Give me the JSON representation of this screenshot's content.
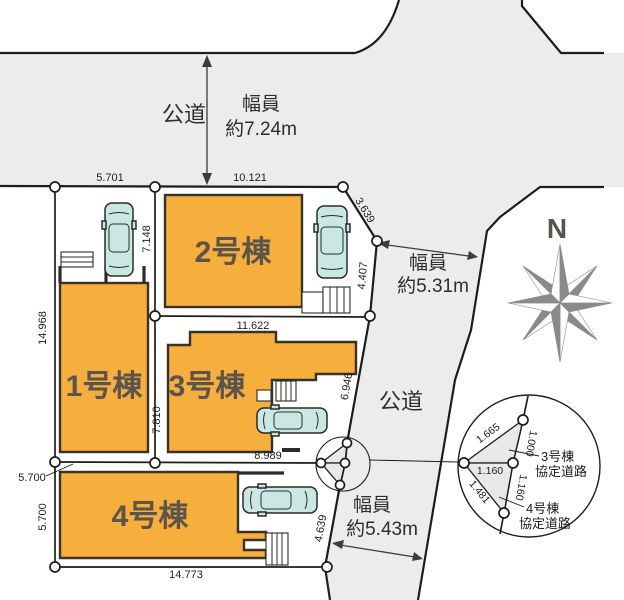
{
  "plan": {
    "buildings": [
      {
        "label": "1号棟"
      },
      {
        "label": "2号棟"
      },
      {
        "label": "3号棟"
      },
      {
        "label": "4号棟"
      }
    ],
    "roads": {
      "top": {
        "name": "公道",
        "width_line1": "幅員",
        "width_line2": "約7.24m"
      },
      "east": {
        "name": "公道",
        "upper_width_line1": "幅員",
        "upper_width_line2": "約5.31m",
        "lower_width_line1": "幅員",
        "lower_width_line2": "約5.43m"
      }
    },
    "compass": {
      "north": "N"
    },
    "dims": {
      "top_left": "5.701",
      "top_right": "10.121",
      "ne_diagonal": "3.639",
      "east_upper": "4.407",
      "west": "14.968",
      "lot2_left": "7.148",
      "lot3_left": "7.810",
      "lot3_top": "11.622",
      "east_mid": "6.946",
      "inner_east": "8.989",
      "lot4_top": "5.700",
      "lot4_left": "5.700",
      "east_lower": "4.639",
      "bottom": "14.773"
    },
    "inset": {
      "seg_upper_left": "1.665",
      "seg_upper_right": "1.000",
      "seg_mid": "1.160",
      "seg_lower_right": "1.160",
      "seg_lower_left": "1.481",
      "label3_l1": "3号棟",
      "label3_l2": "協定道路",
      "label4_l1": "4号棟",
      "label4_l2": "協定道路"
    },
    "colors": {
      "road": "#ECECEB",
      "building": "#F6AE3C",
      "car": "#C9E8E4",
      "inset_triangle": "#E8E8E6"
    }
  }
}
